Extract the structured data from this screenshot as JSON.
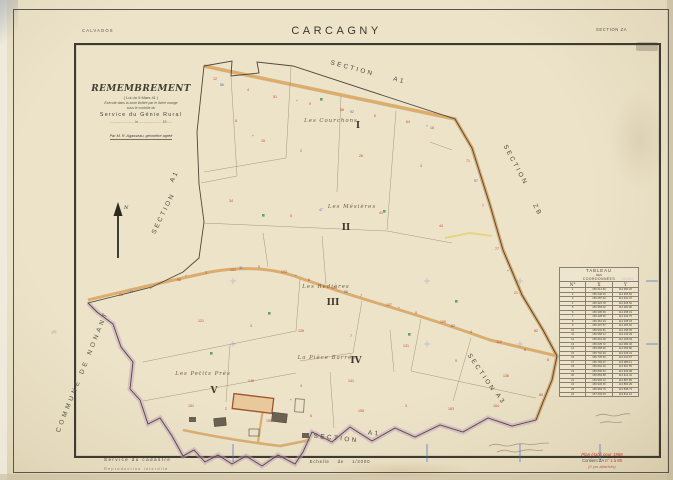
{
  "page": {
    "department": "CALVADOS",
    "title": "CARCAGNY",
    "section": "SECTION ZA"
  },
  "title_block": {
    "heading": "REMEMBREMENT",
    "law": "( Loi du 9 Mars 41 )",
    "zone1": "Exécuté dans la zone limitée par le liséré orange",
    "zone2": "sous le contrôle du",
    "service": "Service du Génie Rural",
    "date_line": "........................ , le ........................ 19......",
    "surveyor": "Par M. R. Agasseau, géomètre agréé"
  },
  "compass_label": "N",
  "commune_label": "COMMUNE DE NONANT",
  "map": {
    "section_labels": [
      {
        "text": "SECTION",
        "x": 352,
        "y": 70,
        "rot": 15
      },
      {
        "text": "A1",
        "x": 399,
        "y": 82,
        "rot": 15
      },
      {
        "text": "SECTION",
        "x": 514,
        "y": 166,
        "rot": 62
      },
      {
        "text": "ZB",
        "x": 536,
        "y": 211,
        "rot": 62
      },
      {
        "text": "A1",
        "x": 176,
        "y": 177,
        "rot": -64
      },
      {
        "text": "SECTION",
        "x": 165,
        "y": 214,
        "rot": -64
      },
      {
        "text": "SECTION",
        "x": 480,
        "y": 374,
        "rot": 56
      },
      {
        "text": "A3",
        "x": 499,
        "y": 400,
        "rot": 56
      },
      {
        "text": "SECTION",
        "x": 336,
        "y": 440,
        "rot": 6
      },
      {
        "text": "A1",
        "x": 374,
        "y": 435,
        "rot": 6
      }
    ],
    "lieu_dits": [
      {
        "text": "Les Courchons",
        "x": 331,
        "y": 122
      },
      {
        "text": "Les Mésières",
        "x": 352,
        "y": 208
      },
      {
        "text": "Les Redières",
        "x": 326,
        "y": 288
      },
      {
        "text": "La Pièce Barrée",
        "x": 327,
        "y": 359
      },
      {
        "text": "Les Petits Prés",
        "x": 203,
        "y": 375
      }
    ],
    "plot_numbers": [
      {
        "text": "I",
        "x": 358,
        "y": 128
      },
      {
        "text": "II",
        "x": 346,
        "y": 230
      },
      {
        "text": "III",
        "x": 333,
        "y": 305
      },
      {
        "text": "IV",
        "x": 356,
        "y": 363
      },
      {
        "text": "V",
        "x": 214,
        "y": 393
      }
    ],
    "red_marks": [
      [
        215,
        80,
        "12"
      ],
      [
        248,
        91,
        "4"
      ],
      [
        275,
        98,
        "51"
      ],
      [
        310,
        105,
        "9"
      ],
      [
        342,
        111,
        "58"
      ],
      [
        375,
        117,
        "6"
      ],
      [
        408,
        123,
        "64"
      ],
      [
        432,
        129,
        "18"
      ],
      [
        468,
        162,
        "71"
      ],
      [
        483,
        207,
        "7"
      ],
      [
        497,
        250,
        "77"
      ],
      [
        516,
        294,
        "21"
      ],
      [
        536,
        332,
        "82"
      ],
      [
        548,
        361,
        "8"
      ],
      [
        541,
        396,
        "86"
      ],
      [
        236,
        122,
        "8"
      ],
      [
        263,
        142,
        "15"
      ],
      [
        301,
        152,
        "2"
      ],
      [
        361,
        157,
        "26"
      ],
      [
        421,
        167,
        "3"
      ],
      [
        231,
        202,
        "34"
      ],
      [
        291,
        217,
        "5"
      ],
      [
        381,
        214,
        "41"
      ],
      [
        441,
        227,
        "44"
      ],
      [
        121,
        296,
        "96"
      ],
      [
        151,
        289,
        "2"
      ],
      [
        179,
        281,
        "98"
      ],
      [
        206,
        274,
        "3"
      ],
      [
        233,
        271,
        "101"
      ],
      [
        259,
        268,
        "5"
      ],
      [
        284,
        273,
        "103"
      ],
      [
        309,
        281,
        "6"
      ],
      [
        334,
        289,
        "105"
      ],
      [
        361,
        297,
        "7"
      ],
      [
        389,
        306,
        "107"
      ],
      [
        416,
        314,
        "9"
      ],
      [
        443,
        323,
        "109"
      ],
      [
        471,
        333,
        "4"
      ],
      [
        499,
        343,
        "112"
      ],
      [
        525,
        351,
        "6"
      ],
      [
        201,
        322,
        "121"
      ],
      [
        251,
        327,
        "3"
      ],
      [
        301,
        332,
        "126"
      ],
      [
        351,
        337,
        "7"
      ],
      [
        406,
        347,
        "131"
      ],
      [
        456,
        362,
        "9"
      ],
      [
        506,
        377,
        "136"
      ],
      [
        351,
        382,
        "141"
      ],
      [
        301,
        387,
        "4"
      ],
      [
        251,
        382,
        "146"
      ],
      [
        191,
        407,
        "151"
      ],
      [
        226,
        410,
        "2"
      ],
      [
        269,
        422,
        "155"
      ],
      [
        311,
        417,
        "6"
      ],
      [
        361,
        412,
        "158"
      ],
      [
        406,
        407,
        "3"
      ],
      [
        451,
        410,
        "163"
      ],
      [
        496,
        407,
        "164"
      ]
    ],
    "blue_marks": [
      [
        222,
        86,
        "86"
      ],
      [
        297,
        102,
        "+"
      ],
      [
        352,
        113,
        "92"
      ],
      [
        427,
        127,
        "+"
      ],
      [
        476,
        182,
        "97"
      ],
      [
        508,
        272,
        "+"
      ],
      [
        131,
        293,
        "24"
      ],
      [
        186,
        277,
        "+"
      ],
      [
        241,
        269,
        "31"
      ],
      [
        296,
        277,
        "+"
      ],
      [
        346,
        293,
        "56"
      ],
      [
        399,
        309,
        "+"
      ],
      [
        453,
        327,
        "62"
      ],
      [
        253,
        137,
        "+"
      ],
      [
        321,
        211,
        "47"
      ],
      [
        291,
        401,
        "+"
      ]
    ],
    "green_marks": [
      [
        320,
        98
      ],
      [
        262,
        214
      ],
      [
        383,
        210
      ],
      [
        268,
        312
      ],
      [
        408,
        333
      ],
      [
        210,
        352
      ],
      [
        455,
        300
      ]
    ],
    "grid_labels": [
      {
        "text": "168.800",
        "x": 627,
        "y": 280
      },
      {
        "text": "168.400",
        "x": 627,
        "y": 343
      }
    ],
    "margin_note": "(2)"
  },
  "table": {
    "title_line1": "TABLEAU",
    "title_line2": "DES",
    "title_line3": "COORDONNÉES",
    "col_num": "N°",
    "col_x": "X",
    "col_y": "Y",
    "rows": [
      [
        "1",
        "156 214 62",
        "114 382 20"
      ],
      [
        "2",
        "156 248 15",
        "114 356 84"
      ],
      [
        "3",
        "156 287 40",
        "114 331 07"
      ],
      [
        "4",
        "156 324 78",
        "114 305 52"
      ],
      [
        "5",
        "156 359 02",
        "114 282 96"
      ],
      [
        "6",
        "156 395 66",
        "114 258 31"
      ],
      [
        "7",
        "156 428 90",
        "114 232 75"
      ],
      [
        "8",
        "156 464 23",
        "114 208 18"
      ],
      [
        "9",
        "156 497 57",
        "114 183 62"
      ],
      [
        "10",
        "156 532 81",
        "114 158 05"
      ],
      [
        "11",
        "156 568 14",
        "114 133 49"
      ],
      [
        "12",
        "156 601 48",
        "114 108 93"
      ],
      [
        "13",
        "156 635 72",
        "114 084 36"
      ],
      [
        "14",
        "156 668 06",
        "114 059 80"
      ],
      [
        "15",
        "156 702 39",
        "114 035 24"
      ],
      [
        "16",
        "156 735 63",
        "114 010 67"
      ],
      [
        "17",
        "156 769 97",
        "113 986 11"
      ],
      [
        "18",
        "156 802 20",
        "113 961 55"
      ],
      [
        "19",
        "156 836 54",
        "113 936 98"
      ],
      [
        "20",
        "156 869 88",
        "113 912 42"
      ],
      [
        "21",
        "156 903 12",
        "113 887 85"
      ],
      [
        "22",
        "156 936 45",
        "113 863 29"
      ],
      [
        "23",
        "156 969 79",
        "113 838 73"
      ],
      [
        "24",
        "157 003 03",
        "113 814 16"
      ]
    ]
  },
  "footer": {
    "cadastre": "Service du cadastre",
    "notice": "Reproduction interdite",
    "scale": "Echelle de 1/2000",
    "note_line1": "Plan établi pour 1968",
    "note_line2_prefix": "Contient ZA n°",
    "note_line2_range": "1 à 89",
    "note_line3": "(2 ym attachés)"
  }
}
